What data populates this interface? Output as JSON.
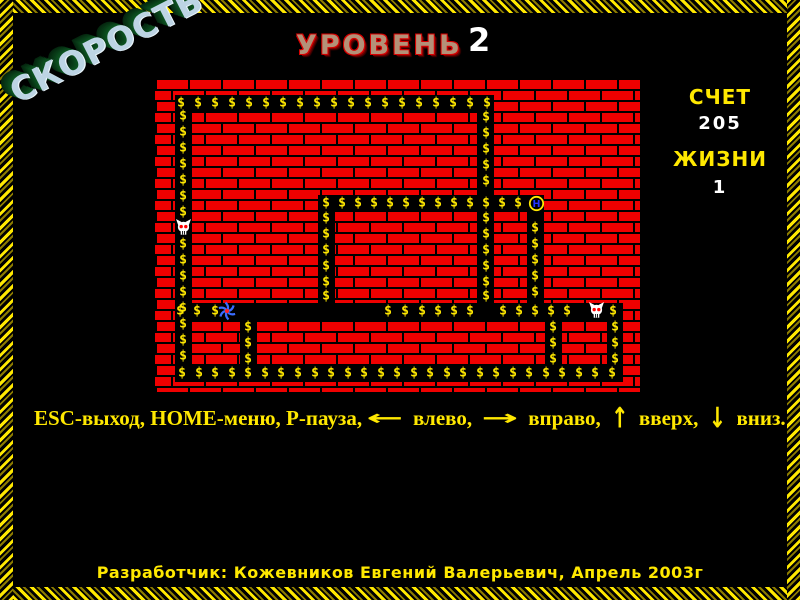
{
  "speed": {
    "text": "СКОРОСТЬ"
  },
  "level": {
    "label": "УРОВЕНЬ",
    "value": "2"
  },
  "score": {
    "label": "СЧЕТ",
    "value": "205"
  },
  "lives": {
    "label": "ЖИЗНИ",
    "value": "1"
  },
  "instructions": {
    "arrows": {
      "left": "←",
      "right": "→",
      "up": "↑",
      "down": "↓"
    },
    "segments": [
      {
        "t": "ESC-выход, HOME-меню, P-пауза,"
      },
      {
        "a": "left"
      },
      {
        "t": " влево, "
      },
      {
        "a": "right"
      },
      {
        "t": " вправо, "
      },
      {
        "a": "up"
      },
      {
        "t": " вверх, "
      },
      {
        "a": "down"
      },
      {
        "t": " вниз."
      }
    ]
  },
  "credits": {
    "text": "Разработчик: Кожевников Евгений Валерьевич, Апрель 2003г"
  },
  "colors": {
    "brick_red": "#ef0000",
    "corridor_black": "#000000",
    "dollar_yellow": "#ffe800",
    "text_yellow": "#ffe800",
    "text_white": "#ffffff",
    "level_face": "#b49178",
    "level_outline": "#d80000",
    "speed_face": "#bdd4e4",
    "speed_extrude": "#0a461c",
    "player_blue": "#3a6cff",
    "player_core": "#ff2020",
    "skull_white": "#ffffff",
    "skull_eye": "#ff0000",
    "bonus_ring": "#ffe800",
    "bonus_letter_blue": "#2135ff",
    "border_yellow": "#ffe800"
  },
  "maze": {
    "x": 155,
    "y": 78,
    "width": 485,
    "height": 314,
    "dollar_symbol": "$",
    "bonus_letter": "H",
    "corridors": [
      {
        "x": 20,
        "y": 17,
        "w": 319,
        "h": 17
      },
      {
        "x": 20,
        "y": 17,
        "w": 17,
        "h": 287
      },
      {
        "x": 163,
        "y": 117,
        "w": 226,
        "h": 17
      },
      {
        "x": 163,
        "y": 117,
        "w": 17,
        "h": 125
      },
      {
        "x": 322,
        "y": 17,
        "w": 17,
        "h": 225
      },
      {
        "x": 372,
        "y": 117,
        "w": 17,
        "h": 125
      },
      {
        "x": 20,
        "y": 225,
        "w": 448,
        "h": 17
      },
      {
        "x": 85,
        "y": 225,
        "w": 17,
        "h": 79
      },
      {
        "x": 390,
        "y": 225,
        "w": 17,
        "h": 79
      },
      {
        "x": 452,
        "y": 225,
        "w": 16,
        "h": 79
      },
      {
        "x": 20,
        "y": 287,
        "w": 448,
        "h": 17
      }
    ],
    "dollar_rows": [
      {
        "y": 25,
        "xs": [
          26,
          43,
          60,
          77,
          94,
          111,
          128,
          145,
          162,
          179,
          196,
          213,
          230,
          247,
          264,
          281,
          298,
          315,
          332
        ]
      },
      {
        "y": 125,
        "xs": [
          171,
          187,
          203,
          219,
          235,
          251,
          267,
          283,
          299,
          315,
          331,
          347,
          363
        ]
      },
      {
        "y": 233,
        "xs": [
          25,
          42,
          60,
          233,
          250,
          267,
          283,
          299,
          315,
          348,
          364,
          380,
          396,
          412,
          458
        ]
      },
      {
        "y": 295,
        "xs": [
          27,
          44,
          60,
          77,
          93,
          110,
          126,
          143,
          160,
          176,
          193,
          209,
          226,
          242,
          259,
          275,
          292,
          308,
          325,
          341,
          358,
          374,
          391,
          407,
          424,
          440,
          457
        ]
      }
    ],
    "dollar_cols": [
      {
        "x": 28,
        "ys": [
          38,
          54,
          70,
          86,
          102,
          118,
          134,
          166,
          182,
          198,
          214,
          230,
          246,
          262,
          278
        ]
      },
      {
        "x": 171,
        "ys": [
          140,
          156,
          172,
          188,
          204,
          218
        ]
      },
      {
        "x": 331,
        "ys": [
          39,
          55,
          71,
          87,
          103,
          140,
          156,
          172,
          188,
          204,
          218
        ]
      },
      {
        "x": 380,
        "ys": [
          150,
          166,
          182,
          198,
          214
        ]
      },
      {
        "x": 93,
        "ys": [
          249,
          265,
          281
        ]
      },
      {
        "x": 398,
        "ys": [
          249,
          265,
          281
        ]
      },
      {
        "x": 460,
        "ys": [
          249,
          265,
          281
        ]
      }
    ],
    "sprites": [
      {
        "type": "skull",
        "x": 20,
        "y": 141
      },
      {
        "type": "skull",
        "x": 433,
        "y": 224
      },
      {
        "type": "player",
        "x": 62,
        "y": 223
      },
      {
        "type": "bonus",
        "x": 373,
        "y": 117
      }
    ]
  }
}
